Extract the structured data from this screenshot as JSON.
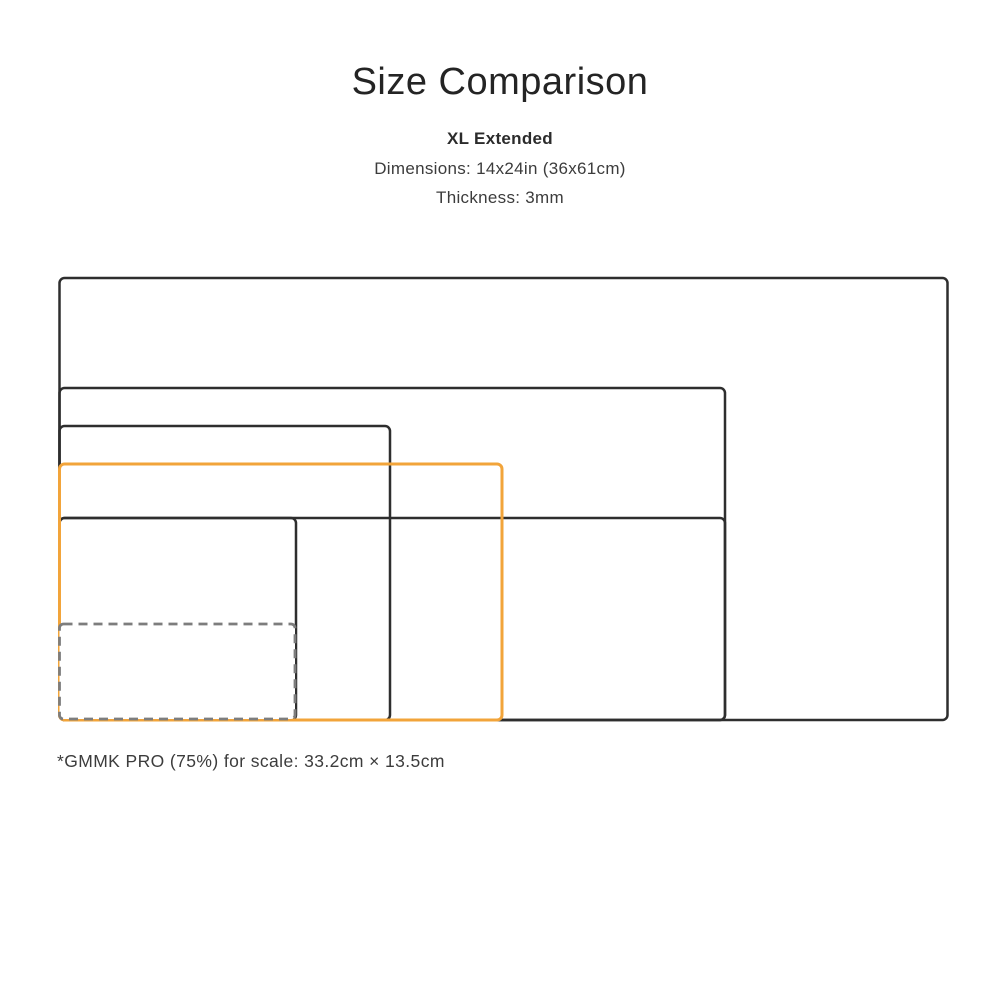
{
  "header": {
    "title": "Size Comparison",
    "product_name": "XL Extended",
    "dimensions_line": "Dimensions: 14x24in (36x61cm)",
    "thickness_line": "Thickness: 3mm"
  },
  "footnote": "*GMMK PRO (75%) for scale: 33.2cm × 13.5cm",
  "colors": {
    "background": "#ffffff",
    "outline": "#2e2e2e",
    "highlight": "#F2A43A",
    "dashed_outline": "#7d7d7d",
    "title_text": "#242424",
    "body_text": "#3c3c3c"
  },
  "diagram": {
    "rects": [
      {
        "name": "size-rect-1",
        "x": 59.5,
        "y": 278,
        "w": 888,
        "h": 442,
        "rx": 5,
        "stroke": "#2e2e2e",
        "stroke_width": 2.5,
        "dash": "",
        "fill": "none"
      },
      {
        "name": "size-rect-2",
        "x": 59.5,
        "y": 388,
        "w": 665.5,
        "h": 332,
        "rx": 5,
        "stroke": "#2e2e2e",
        "stroke_width": 2.5,
        "dash": "",
        "fill": "none"
      },
      {
        "name": "size-rect-3",
        "x": 59.5,
        "y": 426,
        "w": 330.5,
        "h": 294,
        "rx": 5,
        "stroke": "#2e2e2e",
        "stroke_width": 2.5,
        "dash": "",
        "fill": "none"
      },
      {
        "name": "size-rect-4",
        "x": 59.5,
        "y": 518,
        "w": 665.5,
        "h": 202,
        "rx": 5,
        "stroke": "#2e2e2e",
        "stroke_width": 2.5,
        "dash": "",
        "fill": "none"
      },
      {
        "name": "size-rect-5",
        "x": 59.5,
        "y": 518,
        "w": 236.5,
        "h": 202,
        "rx": 5,
        "stroke": "#2e2e2e",
        "stroke_width": 2.5,
        "dash": "",
        "fill": "none"
      },
      {
        "name": "highlighted-size-rect",
        "x": 59.5,
        "y": 464,
        "w": 442.5,
        "h": 256,
        "rx": 5,
        "stroke": "#F2A43A",
        "stroke_width": 3,
        "dash": "",
        "fill": "none"
      },
      {
        "name": "keyboard-scale-rect",
        "x": 59.5,
        "y": 624,
        "w": 235.5,
        "h": 95,
        "rx": 4,
        "stroke": "#7d7d7d",
        "stroke_width": 2.8,
        "dash": "9 6",
        "fill": "#ffffff"
      }
    ]
  }
}
